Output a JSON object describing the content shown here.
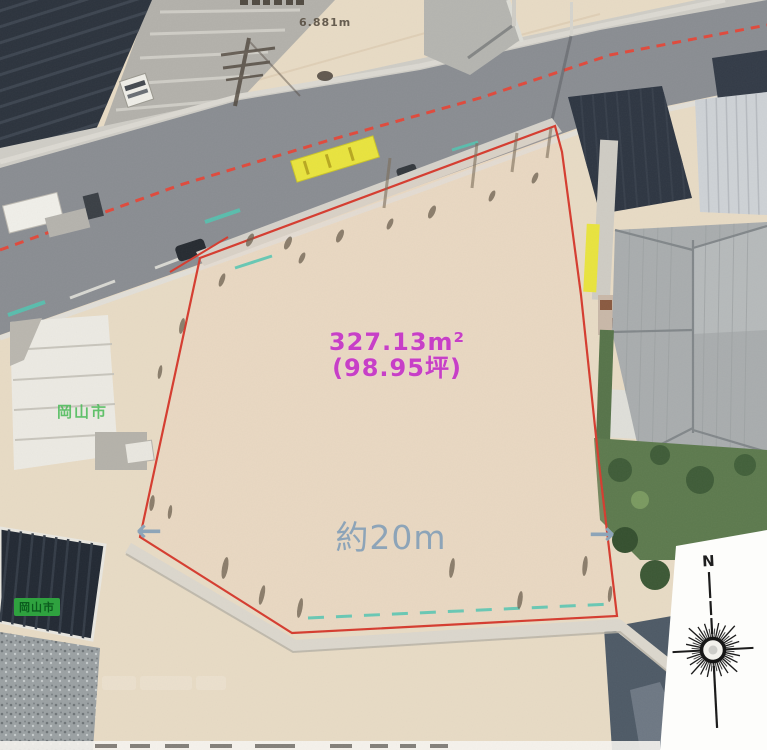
{
  "scene": {
    "type": "aerial-photo-annotation",
    "labels": {
      "area_m2": "327.13m²",
      "area_tsubo": "(98.95坪)",
      "frontage": "約20m",
      "arrow_left": "←",
      "arrow_right": "→",
      "top_dimension": "6.881m",
      "map_label_city": "岡山市",
      "map_label_city_boxed": "岡山市",
      "compass_north": "N"
    },
    "colors": {
      "boundary_red": "#d63c2f",
      "road_dash_red": "#e04a3c",
      "area_text_magenta": "#c73fc7",
      "frontage_text_blue_gray": "#8da4b8",
      "map_label_green": "#2fa23f",
      "curb_teal": "#52c6b2",
      "marker_yellow": "#e9e43e"
    }
  }
}
